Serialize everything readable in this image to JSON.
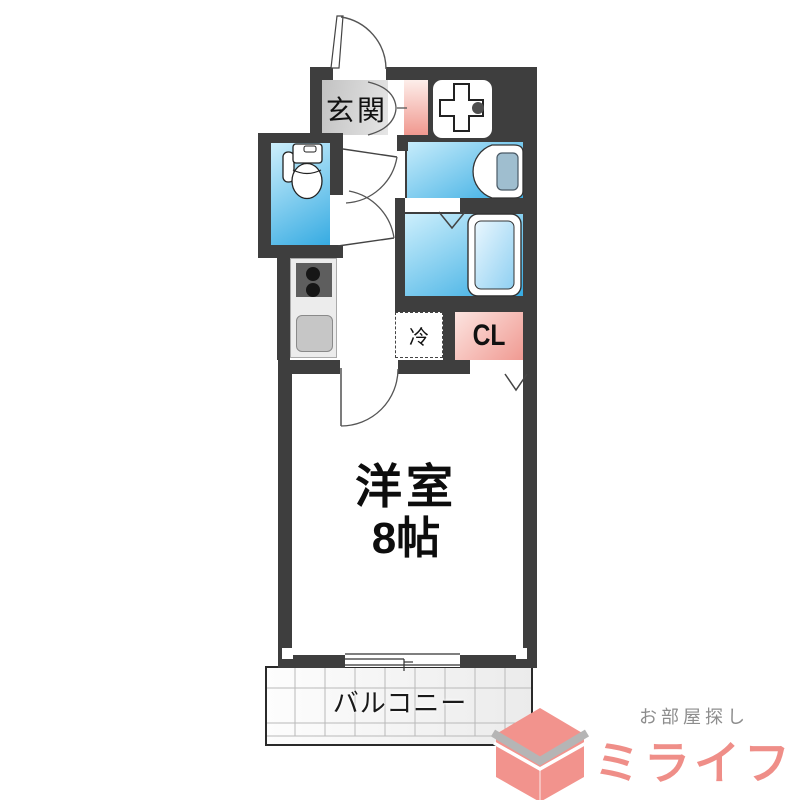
{
  "floorplan": {
    "labels": {
      "entrance": "玄関",
      "room": "洋室",
      "room_size": "8帖",
      "closet": "CL",
      "refrigerator": "冷",
      "balcony": "バルコニー"
    },
    "icons": {
      "toilet": "toilet-icon",
      "bathtub": "bathtub-icon",
      "washbasin": "washbasin-icon",
      "washing_machine_pan": "washing-machine-pan-icon",
      "stove": "stove-icon",
      "kitchen_sink": "kitchen-sink-icon",
      "door_swing": "door-swing-arc",
      "folding_door": "folding-door-v-icon",
      "sliding_window": "sliding-window-icon",
      "logo_cube": "cube-logo-icon"
    },
    "colors": {
      "wall": "#3e3e3e",
      "water_light": "#cdeffc",
      "water_deep": "#36abe2",
      "pink_light": "#fce4e0",
      "pink_deep": "#f09a92",
      "counter_gray": "#ececec",
      "stove_gray": "#5e5e5e",
      "balcony_grid": "#b9b9b9"
    }
  },
  "logo": {
    "tagline": "お部屋探し",
    "brand": "ミライフ",
    "brand_color": "#ef8e88",
    "tagline_color": "#8d8d8d",
    "cube_pink": "#f2938d",
    "cube_gray": "#b5b5b5"
  }
}
